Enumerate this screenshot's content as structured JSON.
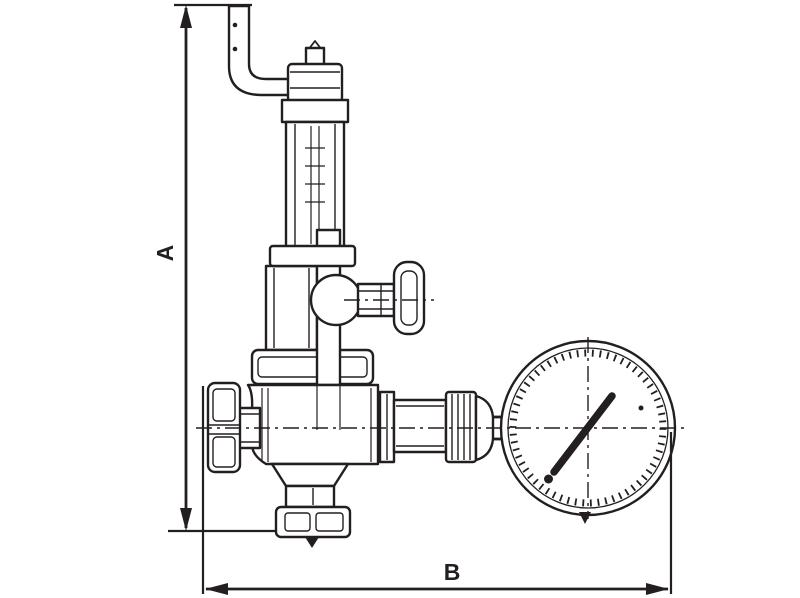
{
  "page": {
    "background_color": "#ffffff"
  },
  "drawing": {
    "type": "technical-line-drawing",
    "subject": "pressure-reducing-valve-with-pressure-gauge",
    "line_color": "#231f20",
    "fill_color": "#ffffff",
    "dimension_labels": {
      "vertical": "A",
      "horizontal": "B"
    },
    "parts": [
      "inlet-elbow-pipe",
      "adjusting-screw-tip",
      "bonnet-top-fitting",
      "bonnet-hex-nut",
      "spring-bonnet-tube",
      "lock-collar",
      "upper-body-tube",
      "stem-column",
      "side-boss",
      "handwheel-stem",
      "handwheel",
      "hex-flange",
      "valve-body",
      "inlet-stub",
      "inlet-coupling-nut",
      "bottom-funnel",
      "bottom-hex-adapter",
      "bottom-neck",
      "bottom-cap-nut",
      "outlet-flange-ring",
      "outlet-spool",
      "outlet-union-nut",
      "outlet-reducer",
      "gauge-stem",
      "pressure-gauge-dial",
      "gauge-needle"
    ]
  }
}
